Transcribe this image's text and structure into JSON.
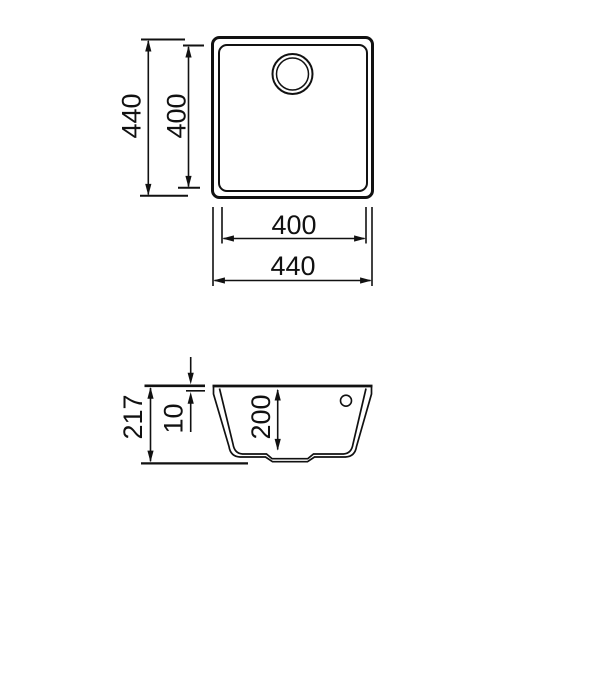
{
  "drawing": {
    "title": "sink-technical-drawing",
    "line_color": "#111111",
    "background": "#ffffff",
    "top_view": {
      "outer_height_label": "440",
      "inner_height_label": "400",
      "inner_width_label": "400",
      "outer_width_label": "440"
    },
    "section_view": {
      "total_height_label": "217",
      "rim_height_label": "10",
      "bowl_depth_label": "200"
    }
  }
}
